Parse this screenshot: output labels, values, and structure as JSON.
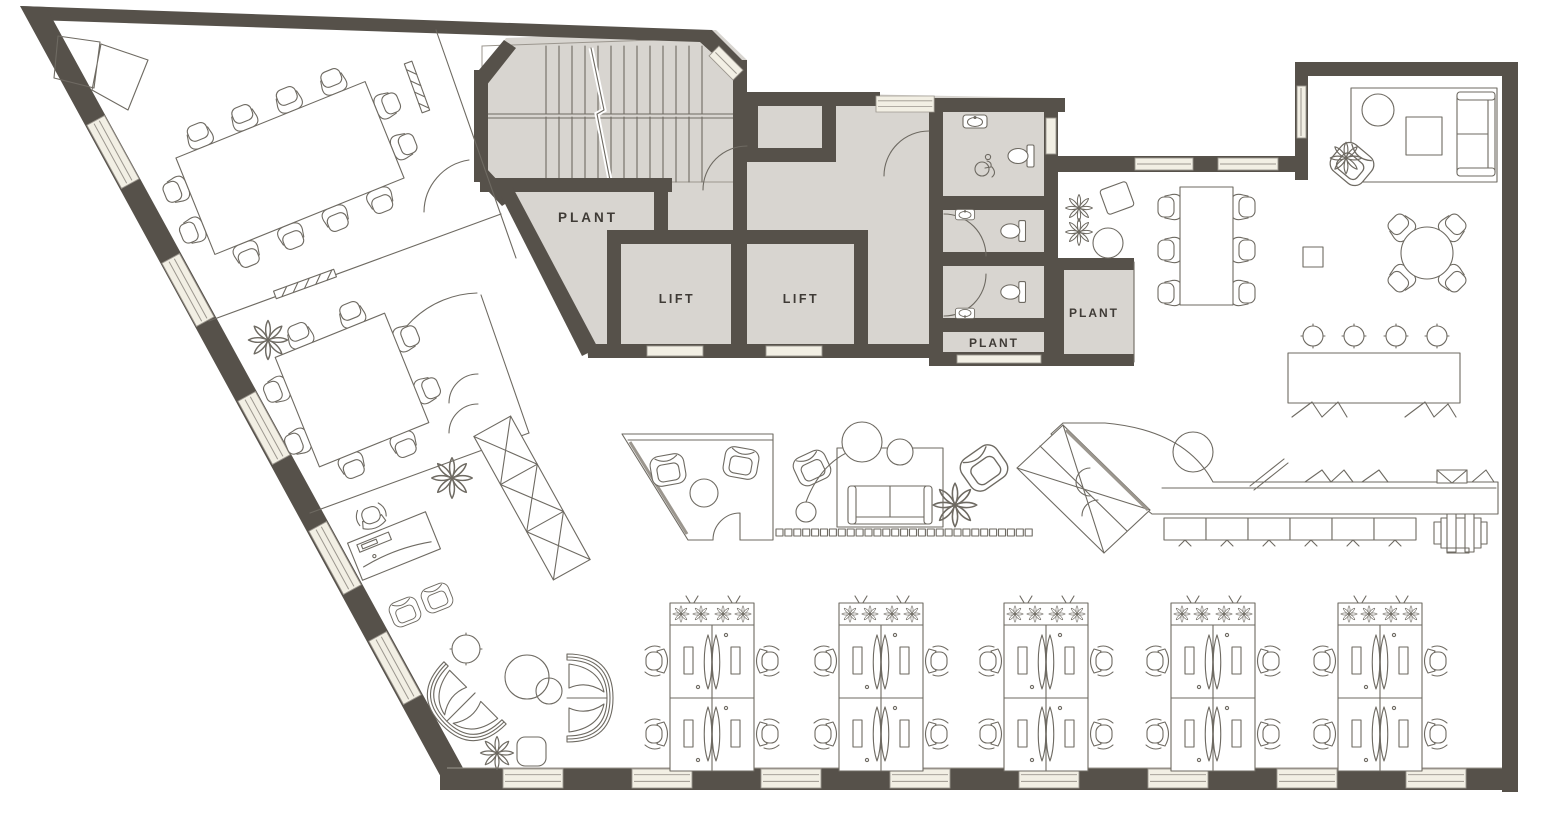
{
  "page": {
    "type": "architectural-floor-plan",
    "content": "office level plan with core, meeting rooms, open office and lounge areas"
  },
  "colors": {
    "wall": "#56514a",
    "core_fill": "#d8d5d0",
    "window_fill": "#f2efe4",
    "line": "#6e6a62",
    "light_line": "#9b968e",
    "label_text": "#3f3b36",
    "background": "#ffffff"
  },
  "labels": {
    "stair_plant": "PLANT",
    "lift_1": "LIFT",
    "lift_2": "LIFT",
    "wc_plant": "PLANT",
    "store_plant": "PLANT"
  },
  "inventory": {
    "workstation_clusters": 5,
    "desks_per_cluster": 4,
    "total_desks": 20,
    "large_meeting_room_seats": 12,
    "small_meeting_room_seats": 8,
    "long_table_seats": 6,
    "bar_stools": 4,
    "round_dining_seats": 4,
    "lifts": 2,
    "wcs": 3,
    "accessible_wcs": 1
  }
}
